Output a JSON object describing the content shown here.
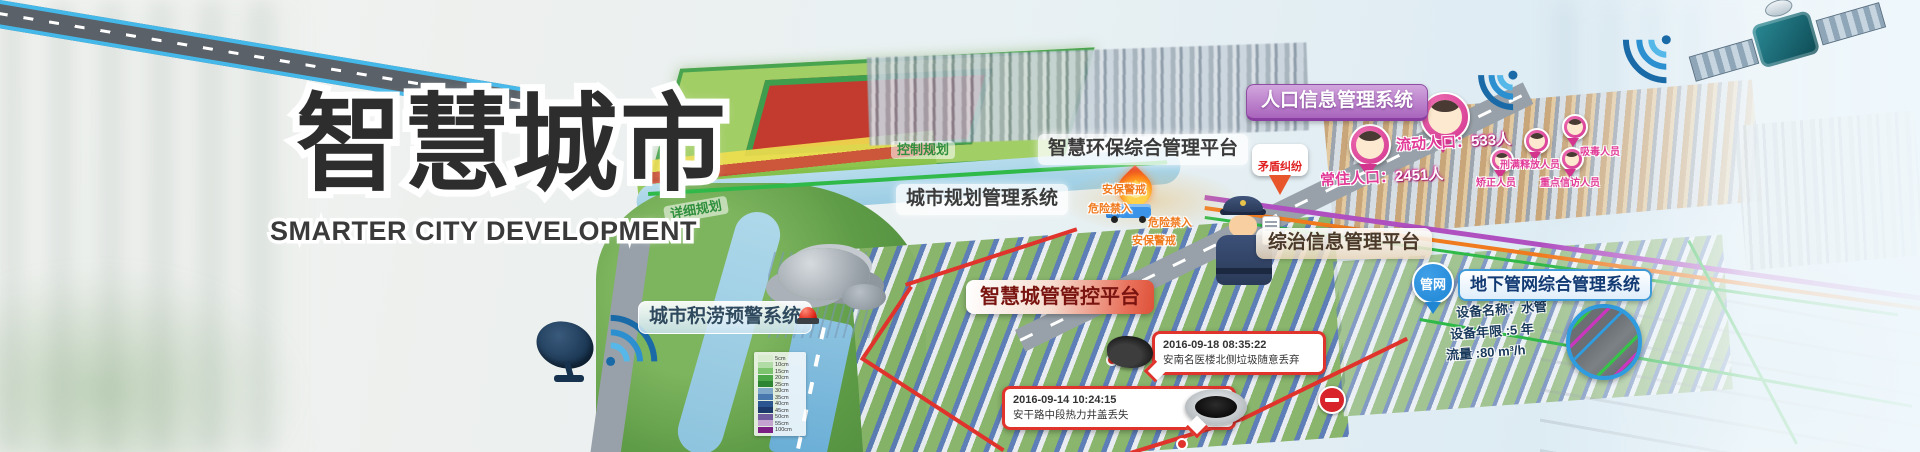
{
  "title": {
    "main": "智慧城市",
    "subtitle": "SMARTER CITY DEVELOPMENT"
  },
  "system_labels": {
    "population": "人口信息管理系统",
    "environment": "智慧环保综合管理平台",
    "urban_planning": "城市规划管理系统",
    "governance": "综治信息管理平台",
    "city_management": "智慧城管管控平台",
    "pipe_network": "地下管网综合管理系统",
    "flood_warning": "城市积涝预警系统"
  },
  "map_annotations": {
    "control_planning": "控制规划",
    "detailed_planning": "详细规划",
    "pipe_badge": "管网",
    "security_alert": "安保警戒",
    "danger_no_entry": "危险禁入",
    "dispute": "矛盾纠纷"
  },
  "population_markers": {
    "floating_label": "流动人口：",
    "floating_value": "533人",
    "resident_label": "常住人口：",
    "resident_value": "2451人",
    "categories": [
      "吸毒人员",
      "刑满释放人员",
      "矫正人员",
      "重点信访人员"
    ]
  },
  "pipe_info": {
    "device_name": "设备名称：水管",
    "device_age": "设备年限 :5 年",
    "flow_rate": "流量 :80 m³/h"
  },
  "events": [
    {
      "time": "2016-09-18 08:35:22",
      "desc": "安南名医楼北侧垃圾随意丢弃"
    },
    {
      "time": "2016-09-14 10:24:15",
      "desc": "安干路中段热力井盖丢失"
    }
  ],
  "flood_scale": {
    "items": [
      {
        "label": "5cm",
        "color": "#d9ecd0"
      },
      {
        "label": "10cm",
        "color": "#b2dca6"
      },
      {
        "label": "15cm",
        "color": "#7cc36d"
      },
      {
        "label": "20cm",
        "color": "#4aa647"
      },
      {
        "label": "25cm",
        "color": "#2d8531"
      },
      {
        "label": "30cm",
        "color": "#7fa8c9"
      },
      {
        "label": "35cm",
        "color": "#4878ad"
      },
      {
        "label": "40cm",
        "color": "#2b568f"
      },
      {
        "label": "45cm",
        "color": "#1c3a6b"
      },
      {
        "label": "50cm",
        "color": "#6f5b9e"
      },
      {
        "label": "55cm",
        "color": "#c5a3d1"
      },
      {
        "label": "100cm",
        "color": "#7c1f85"
      }
    ]
  },
  "colors": {
    "magenta_population": "#e23a97",
    "label_purple": "#a964bd",
    "alert_red": "#e0332c",
    "pipe_blue": "#1f86d4",
    "warning_orange": "#f07a1e",
    "planning_green": "#2f8f3c"
  }
}
